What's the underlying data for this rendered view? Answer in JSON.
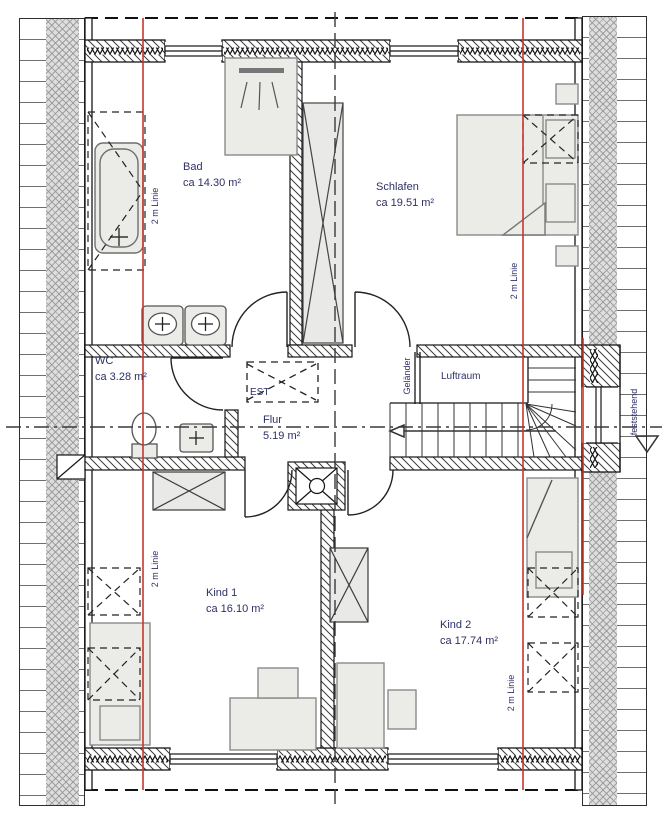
{
  "drawing": {
    "type": "floor-plan",
    "rooms": {
      "bad": {
        "name": "Bad",
        "area": "ca 14.30 m²"
      },
      "schlafen": {
        "name": "Schlafen",
        "area": "ca 19.51 m²"
      },
      "wc": {
        "name": "WC",
        "area": "ca 3.28 m²"
      },
      "flur": {
        "name": "Flur",
        "area": "5.19 m²"
      },
      "kind1": {
        "name": "Kind 1",
        "area": "ca 16.10 m²"
      },
      "kind2": {
        "name": "Kind 2",
        "area": "ca 17.74 m²"
      }
    },
    "annotations": {
      "luftraum": "Luftraum",
      "gelaender": "Geländer",
      "est": "EST",
      "feststehend": "feststehend",
      "two_m_line": "2 m Linie"
    },
    "colors": {
      "height_line_red": "#c5372e",
      "label_text": "#2e3066",
      "wall_line": "#161616"
    }
  }
}
